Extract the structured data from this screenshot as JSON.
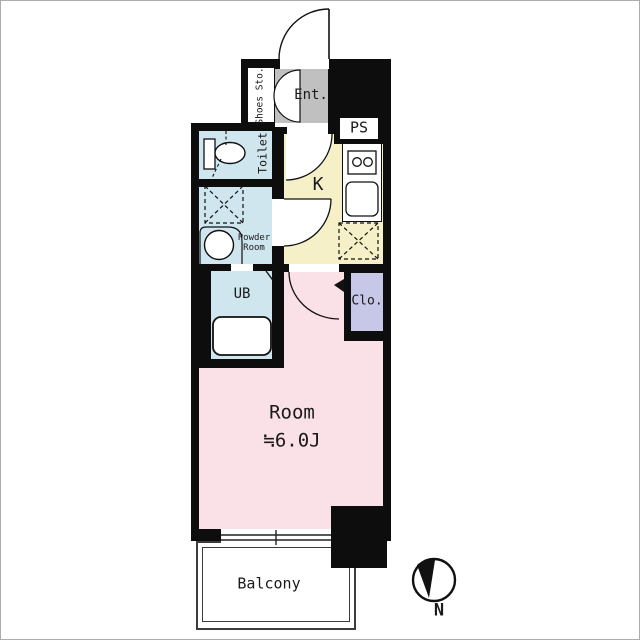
{
  "diagram_type": "apartment-floor-plan",
  "rooms": {
    "shoes": {
      "label": "Shoes Sto."
    },
    "entrance": {
      "label": "Ent."
    },
    "pipe_space": {
      "label": "PS"
    },
    "kitchen": {
      "label": "K"
    },
    "toilet": {
      "label": "Toilet"
    },
    "powder": {
      "label": "Powder\nRoom"
    },
    "unit_bath": {
      "label": "UB"
    },
    "closet": {
      "label": "Clo."
    },
    "main_room": {
      "label": "Room",
      "size": "≒6.0J"
    },
    "balcony": {
      "label": "Balcony"
    }
  },
  "compass": {
    "north_label": "N"
  },
  "fixtures": [
    "toilet-bowl",
    "toilet-tank",
    "washing-machine-space",
    "powder-sink",
    "bathtub",
    "stove-burners",
    "kitchen-sink",
    "refrigerator-space",
    "entrance-door",
    "shoes-cabinet-doors",
    "kitchen-door",
    "powder-door",
    "room-door",
    "sliding-window"
  ],
  "colors": {
    "wall": "#0d0d0d",
    "entrance": "#c0c0c0",
    "kitchen": "#f5f0c8",
    "water_rooms": "#cfe6ef",
    "closet": "#c7c7e7",
    "room": "#fae1e7",
    "balcony": "#ffffff",
    "background": "#ffffff"
  }
}
